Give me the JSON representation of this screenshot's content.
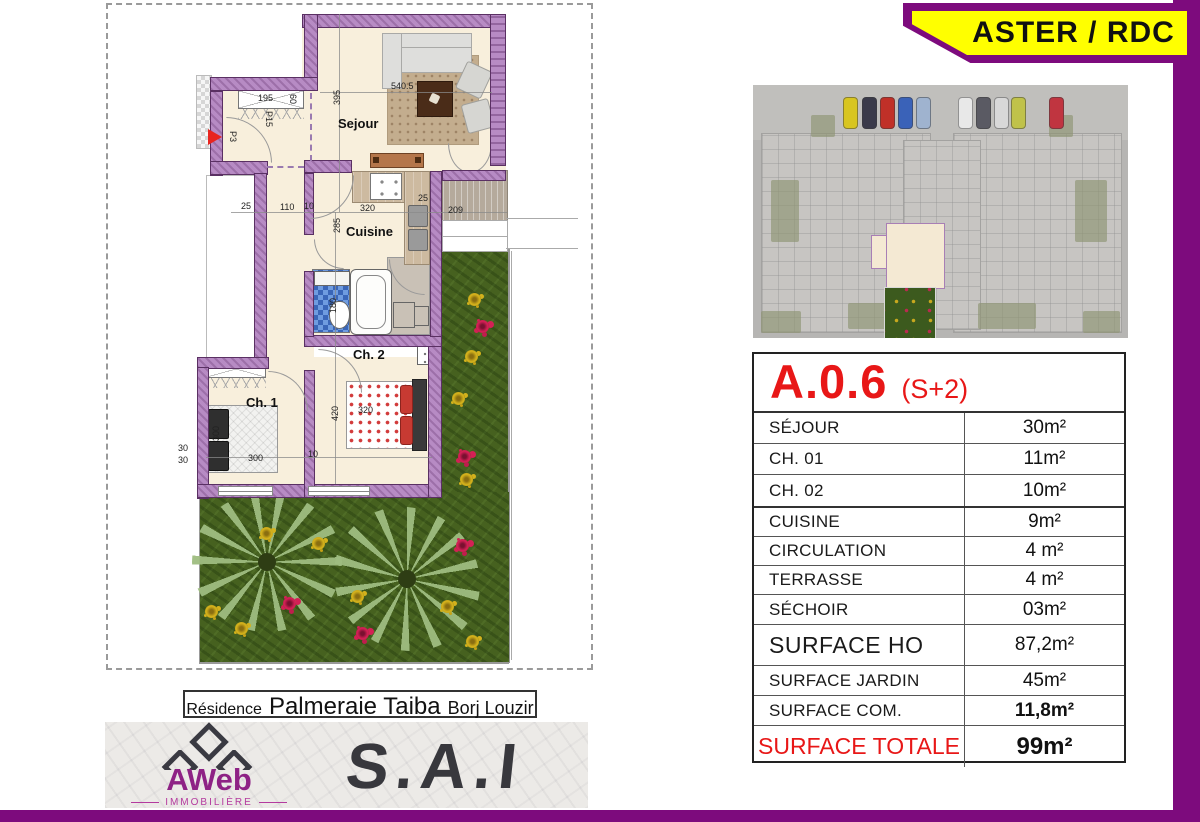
{
  "banner": {
    "label": "ASTER / RDC"
  },
  "site_plan": {
    "cars": [
      {
        "x": 90,
        "c": "#d8c520"
      },
      {
        "x": 109,
        "c": "#3a3a4a"
      },
      {
        "x": 127,
        "c": "#c03028"
      },
      {
        "x": 145,
        "c": "#3a62b8"
      },
      {
        "x": 163,
        "c": "#9fb3cf"
      },
      {
        "x": 205,
        "c": "#e8e8e8"
      },
      {
        "x": 223,
        "c": "#5a5a63"
      },
      {
        "x": 241,
        "c": "#d8d8d8"
      },
      {
        "x": 258,
        "c": "#c0c24a"
      },
      {
        "x": 296,
        "c": "#c03540"
      }
    ]
  },
  "info_table": {
    "unit": "A.0.6",
    "unit_suffix": "(S+2)",
    "rows": [
      {
        "label": "SÉJOUR",
        "value": "30m²",
        "h": "h31"
      },
      {
        "label": "CH. 01",
        "value": "11m²",
        "h": "h31"
      },
      {
        "label": "CH. 02",
        "value": "10m²",
        "h": "h33",
        "sep": true
      },
      {
        "label": "CUISINE",
        "value": "9m²",
        "h": "h29"
      },
      {
        "label": "CIRCULATION",
        "value": "4 m²",
        "h": "h29"
      },
      {
        "label": "TERRASSE",
        "value": "4 m²",
        "h": "h29"
      },
      {
        "label": "SÉCHOIR",
        "value": "03m²"
      },
      {
        "label": "SURFACE HO",
        "value": "87,2m²",
        "size": "lg",
        "label_large": true
      },
      {
        "label": "SURFACE JARDIN",
        "value": "45m²"
      },
      {
        "label": "SURFACE COM.",
        "value": "11,8m²",
        "value_bold": true
      },
      {
        "label": "SURFACE TOTALE",
        "value": "99m²",
        "size": "lg",
        "total": true
      }
    ]
  },
  "plan": {
    "labels": [
      {
        "t": "Sejour",
        "x": 230,
        "y": 111,
        "cls": "room"
      },
      {
        "t": "Cuisine",
        "x": 238,
        "y": 219,
        "cls": "room"
      },
      {
        "t": "Ch. 2",
        "x": 245,
        "y": 342,
        "cls": "room"
      },
      {
        "t": "Ch. 1",
        "x": 138,
        "y": 390,
        "cls": "room"
      },
      {
        "t": "195",
        "x": 150,
        "y": 88
      },
      {
        "t": "60",
        "x": 190,
        "y": 89,
        "rot": 2
      },
      {
        "t": "P15",
        "x": 166,
        "y": 106,
        "rot": 2
      },
      {
        "t": "P3",
        "x": 130,
        "y": 126,
        "rot": 2
      },
      {
        "t": "395",
        "x": 224,
        "y": 100,
        "rot": 1
      },
      {
        "t": "540.5",
        "x": 283,
        "y": 76
      },
      {
        "t": "25",
        "x": 133,
        "y": 196
      },
      {
        "t": "110",
        "x": 172,
        "y": 197
      },
      {
        "t": "10",
        "x": 196,
        "y": 196
      },
      {
        "t": "320",
        "x": 252,
        "y": 198
      },
      {
        "t": "25",
        "x": 310,
        "y": 188
      },
      {
        "t": "209",
        "x": 340,
        "y": 200
      },
      {
        "t": "285",
        "x": 224,
        "y": 228,
        "rot": 1
      },
      {
        "t": "180",
        "x": 220,
        "y": 308,
        "rot": 1
      },
      {
        "t": "420",
        "x": 222,
        "y": 416,
        "rot": 1
      },
      {
        "t": "320",
        "x": 250,
        "y": 400
      },
      {
        "t": "10",
        "x": 200,
        "y": 444
      },
      {
        "t": "300",
        "x": 140,
        "y": 448
      },
      {
        "t": "300",
        "x": 103,
        "y": 436,
        "rot": 1
      },
      {
        "t": "30",
        "x": 70,
        "y": 438
      },
      {
        "t": "30",
        "x": 70,
        "y": 450
      }
    ],
    "flowers": [
      {
        "x": 360,
        "y": 288,
        "k": "y"
      },
      {
        "x": 344,
        "y": 387,
        "k": "y"
      },
      {
        "x": 352,
        "y": 468,
        "k": "y"
      },
      {
        "x": 204,
        "y": 532,
        "k": "y"
      },
      {
        "x": 152,
        "y": 522,
        "k": "y"
      },
      {
        "x": 97,
        "y": 600,
        "k": "y"
      },
      {
        "x": 127,
        "y": 617,
        "k": "y"
      },
      {
        "x": 243,
        "y": 585,
        "k": "y"
      },
      {
        "x": 333,
        "y": 595,
        "k": "y"
      },
      {
        "x": 358,
        "y": 630,
        "k": "y"
      },
      {
        "x": 357,
        "y": 345,
        "k": "y"
      },
      {
        "x": 368,
        "y": 315,
        "k": "r"
      },
      {
        "x": 350,
        "y": 445,
        "k": "r"
      },
      {
        "x": 348,
        "y": 534,
        "k": "r"
      },
      {
        "x": 175,
        "y": 592,
        "k": "r"
      },
      {
        "x": 248,
        "y": 622,
        "k": "r"
      }
    ]
  },
  "residence": {
    "prefix": "Résidence",
    "name": "Palmeraie Taiba",
    "suffix": "Borj Louzir"
  },
  "footer": {
    "agency": "AWeb",
    "agency_sub": "IMMOBILIÈRE",
    "company": "S.A.I"
  }
}
